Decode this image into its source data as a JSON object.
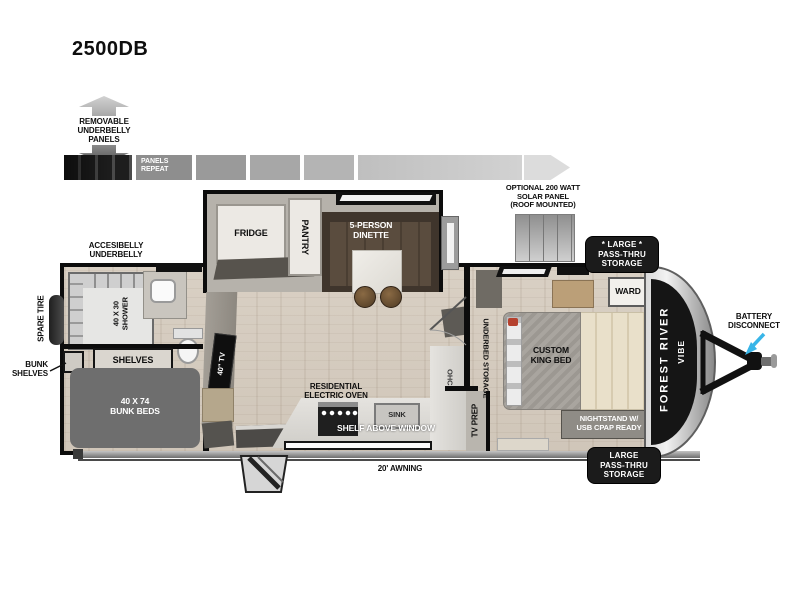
{
  "title": "2500DB",
  "colors": {
    "accent_arrow": "#38b5e8",
    "badge_bg": "#1b1b1b",
    "wall": "#0c0c0c"
  },
  "legend": {
    "removable_panels": [
      "REMOVABLE",
      "UNDERBELLY",
      "PANELS"
    ],
    "panels_repeat": [
      "PANELS",
      "REPEAT"
    ],
    "solar_panel": [
      "OPTIONAL 200 WATT",
      "SOLAR PANEL",
      "(ROOF MOUNTED)"
    ],
    "accessible_underbelly": [
      "ACCESIBELLY",
      "UNDERBELLY"
    ]
  },
  "exterior": {
    "storage_front_top": [
      "* LARGE *",
      "PASS-THRU",
      "STORAGE"
    ],
    "storage_front_bottom": [
      "LARGE",
      "PASS-THRU",
      "STORAGE"
    ],
    "battery_disconnect": [
      "BATTERY",
      "DISCONNECT"
    ],
    "awning": "20' AWNING",
    "spare_tire": "SPARE TIRE",
    "brand_line1": "FOREST RIVER",
    "brand_line2": "VIBE"
  },
  "bathroom": {
    "shower": [
      "40 X 30",
      "SHOWER"
    ],
    "shelves": "SHELVES"
  },
  "bunk_room": {
    "bunk_beds": [
      "40 X 74",
      "BUNK BEDS"
    ],
    "bunk_shelves": [
      "BUNK",
      "SHELVES"
    ],
    "tv": "40\" TV"
  },
  "kitchen": {
    "fridge": "FRIDGE",
    "pantry": "PANTRY",
    "dinette": [
      "5-PERSON",
      "DINETTE"
    ],
    "oven": [
      "RESIDENTIAL",
      "ELECTRIC OVEN"
    ],
    "sink": "SINK",
    "shelf_above_window": "SHELF ABOVE WINDOW",
    "ohc": "OHC"
  },
  "bedroom": {
    "bed": [
      "CUSTOM",
      "KING BED"
    ],
    "underbed_storage": "UNDERBED STORAGE",
    "tv_prep": "TV PREP",
    "wardrobe": "WARD",
    "nightstand": [
      "NIGHTSTAND W/",
      "USB CPAP READY"
    ]
  }
}
